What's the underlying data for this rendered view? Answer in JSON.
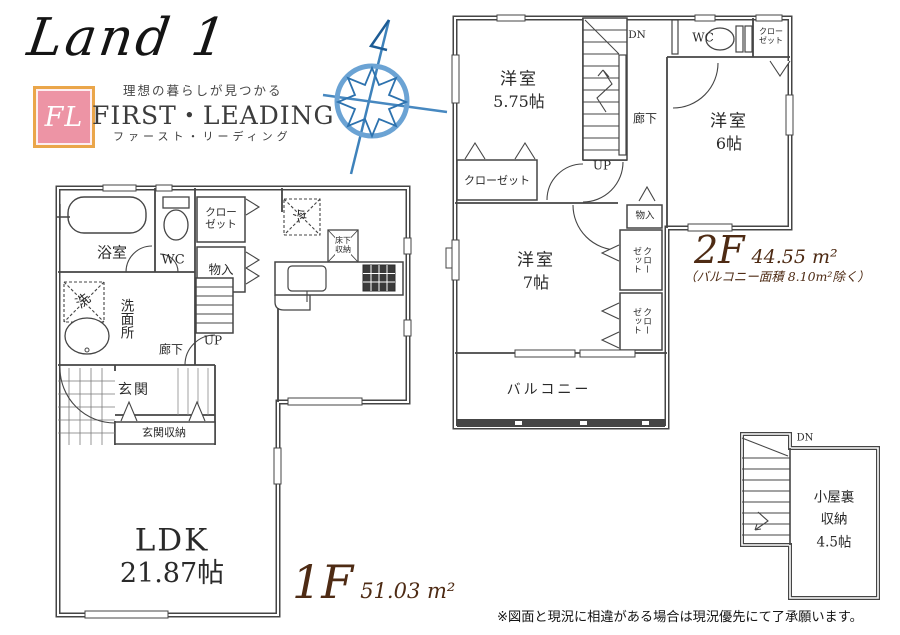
{
  "branding": {
    "logo": "Land 1",
    "badge": "FL",
    "tagline": "理想の暮らしが見つかる",
    "company_en": "FIRST・LEADING",
    "company_kana": "ファースト・リーディング"
  },
  "icons": {
    "compass": "compass-rose-icon"
  },
  "floor1": {
    "title": "1F",
    "area": "51.03 m²",
    "ldk": {
      "name": "LDK",
      "size": "21.87帖"
    },
    "bath": "浴室",
    "wc": "WC",
    "washroom": "洗面所",
    "laundry": "洗",
    "closet_line1": "クロー",
    "closet_line2": "ゼット",
    "storage_small": "物入",
    "hallway": "廊下",
    "stairs_up": "UP",
    "entrance": "玄関",
    "entrance_storage": "玄関収納",
    "fridge": "冷",
    "underfloor_line1": "床下",
    "underfloor_line2": "収納"
  },
  "floor2": {
    "title": "2F",
    "area": "44.55 m²",
    "area_note": "（バルコニー面積 8.10m²除く）",
    "room_a": {
      "name": "洋室",
      "size": "5.75帖"
    },
    "room_b": {
      "name": "洋室",
      "size": "6帖"
    },
    "room_c": {
      "name": "洋室",
      "size": "7帖"
    },
    "closet": "クローゼット",
    "closet_small_line1": "クロー",
    "closet_small_line2": "ゼット",
    "closet_v_line1": "クロー",
    "closet_v_line2": "ゼット",
    "storage_small": "物入",
    "hallway": "廊下",
    "wc": "WC",
    "stairs_dn": "DN",
    "stairs_up": "UP",
    "balcony": "バルコニー"
  },
  "attic": {
    "stairs_dn": "DN",
    "label_line1": "小屋裏",
    "label_line2": "収納",
    "label_line3": "4.5帖"
  },
  "footer": {
    "disclaimer": "※図面と現況に相違がある場合は現況優先にて了承願います。"
  }
}
